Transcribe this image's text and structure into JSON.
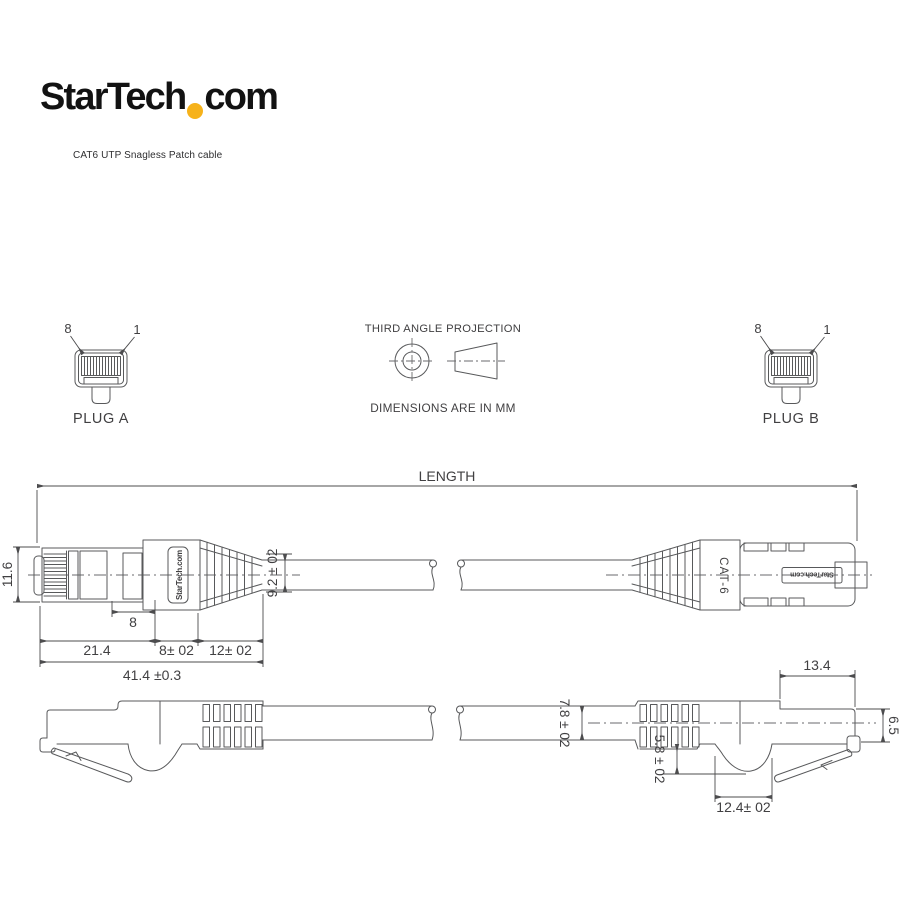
{
  "header": {
    "logo_part1": "StarTech",
    "logo_part2": "com",
    "dot_color": "#F6B21B",
    "caption": "CAT6 UTP Snagless Patch cable"
  },
  "projection": {
    "title": "THIRD ANGLE PROJECTION",
    "note": "DIMENSIONS ARE IN MM"
  },
  "plug_a": {
    "label": "PLUG A",
    "pin_left": "8",
    "pin_right": "1"
  },
  "plug_b": {
    "label": "PLUG B",
    "pin_left": "8",
    "pin_right": "1"
  },
  "top_view": {
    "length_label": "LENGTH",
    "plug_height": "11.6",
    "cable_od": "9.2 ± 02",
    "latch_window": "8",
    "seg_plug": "21.4",
    "seg_mid": "8± 02",
    "seg_boot": "12± 02",
    "overall_length": "41.4 ±0.3",
    "boot_print_left": "StarTech.com",
    "boot_print_cat": "CAT-6",
    "body_print_right": "StarTech.com"
  },
  "side_view": {
    "cable_od": "7.8 ± 02",
    "latch_depth": "5.8 ± 02",
    "latch_recess_width": "12.4± 02",
    "plug_length": "13.4",
    "plug_height": "6.5"
  },
  "colors": {
    "line": "#58595B",
    "text": "#414042",
    "accent": "#F6B21B"
  }
}
